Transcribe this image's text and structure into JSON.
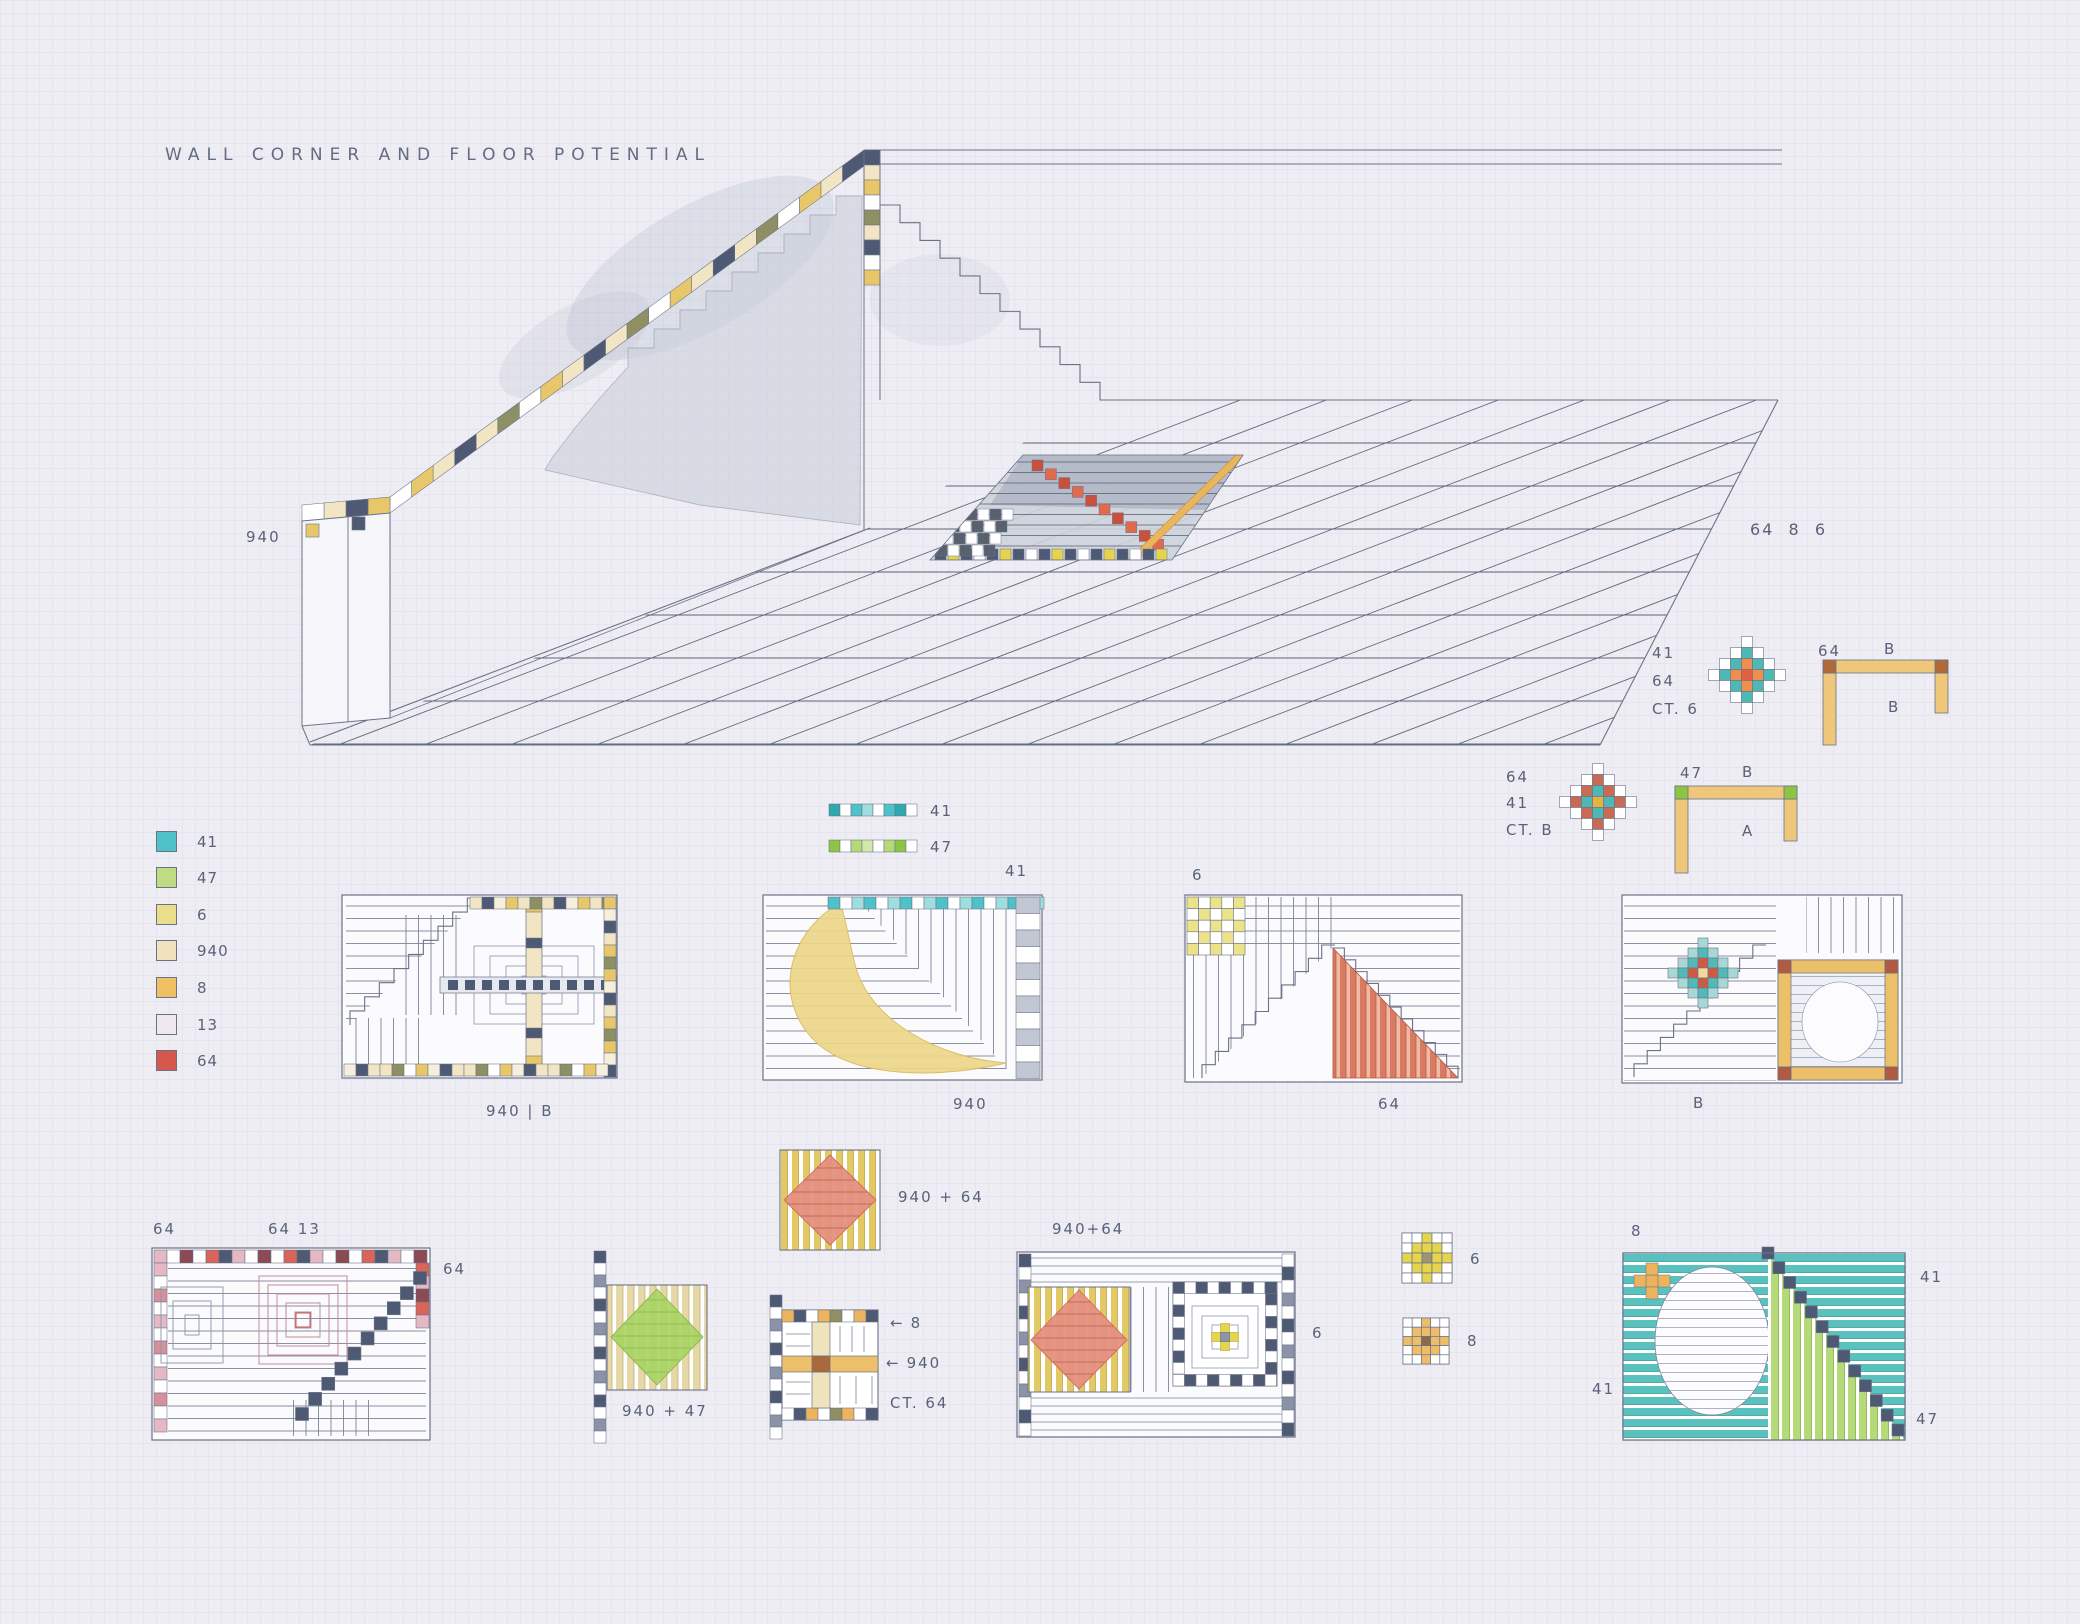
{
  "title": "WALL CORNER AND FLOOR POTENTIAL",
  "palette": {
    "ink": "#6a7288",
    "pencil": "#59627a",
    "paper_panel": "#fbfafc",
    "c41": "#4ec2c8",
    "c47": "#b5d977",
    "c6": "#ece289",
    "c940": "#f2e5c4",
    "c8": "#f0bd60",
    "c13": "#eae7ef",
    "c64": "#d9655a",
    "slate": "#4e5a74",
    "olive": "#8e8f63",
    "amber": "#e8c76a",
    "amber_deep": "#b06a3a",
    "teal_stripe": "#59c2bf",
    "green_stripe": "#b7da79",
    "yellow_swoosh": "#ecd78a",
    "red_tri": "#d97a62",
    "pink": "#e4b9c3",
    "wall_gray": "#c9ced9",
    "yellow_bright": "#e5d44e"
  },
  "iso": {
    "wall_label": "940",
    "note_top_right": "64  8  6"
  },
  "legend": {
    "items": [
      {
        "code": "41",
        "color": "#4ec2c8"
      },
      {
        "code": "47",
        "color": "#c0dc82"
      },
      {
        "code": "6",
        "color": "#eade8c"
      },
      {
        "code": "940",
        "color": "#f0e2bc"
      },
      {
        "code": "8",
        "color": "#f0c065"
      },
      {
        "code": "13",
        "color": "#eee9f0"
      },
      {
        "code": "64",
        "color": "#d6574d"
      }
    ]
  },
  "strips": [
    {
      "code": "41"
    },
    {
      "code": "47"
    }
  ],
  "details": [
    {
      "lines": "41\n64\nCT. 6",
      "bracket_top_left": "64",
      "bracket_top_right": "B",
      "bracket_below": "B"
    },
    {
      "lines": "64\n41\nCT. B",
      "bracket_top_left": "47",
      "bracket_top_right": "B",
      "bracket_below": "A"
    }
  ],
  "row1": [
    {
      "caption": "940 | B"
    },
    {
      "caption": "940",
      "top_label": "41"
    },
    {
      "caption": "64",
      "top_label": "6"
    },
    {
      "caption": "B"
    }
  ],
  "row2": {
    "panel_a": {
      "top_left": "64",
      "top_center": "64 13",
      "right": "64"
    },
    "sq_940_64": {
      "caption": "940 + 64"
    },
    "sq_940_47": {
      "caption": "940 + 47"
    },
    "grid_sq": {
      "arrow_char": "←",
      "arrow_1": "8",
      "arrow_2": "940",
      "caption": "CT. 64"
    },
    "panel_d": {
      "top_label": "940+64",
      "right_label": "6"
    },
    "small_6": {
      "label": "6"
    },
    "small_8": {
      "label": "8"
    },
    "panel_f": {
      "top_label": "8",
      "right_top": "41",
      "left_bottom": "41",
      "right_bottom": "47"
    }
  }
}
